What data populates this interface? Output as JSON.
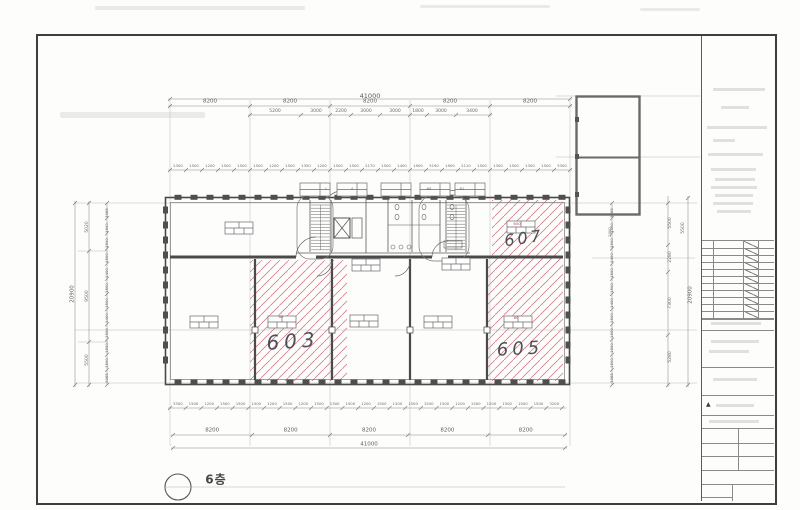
{
  "floor_plan": {
    "floor_label": "6층",
    "room_labels": {
      "left": "603",
      "right": "605",
      "upper": "607"
    },
    "window_tags": [
      "1",
      "4",
      "65",
      "61"
    ],
    "desk_tags": [
      "60",
      "60",
      "600"
    ]
  },
  "dimensions": {
    "top_total": "41000",
    "top_row2": [
      "8200",
      "8200",
      "8200",
      "8200",
      "8200"
    ],
    "top_row3": [
      "5200",
      "3000",
      "2200",
      "3000",
      "3000",
      "1800",
      "3000",
      "3400"
    ],
    "top_small": [
      "2300",
      "1500",
      "1200",
      "1500",
      "1500",
      "1500",
      "1200",
      "1500",
      "1350",
      "1200",
      "1500",
      "1500",
      "2170",
      "1500",
      "1400",
      "1900",
      "3190",
      "1900",
      "2110",
      "1500",
      "1300",
      "1500",
      "1300",
      "1500",
      "3300"
    ],
    "bottom_small": [
      "3300",
      "1500",
      "1200",
      "1500",
      "1500",
      "1500",
      "1200",
      "1500",
      "1200",
      "1500",
      "1300",
      "1500",
      "1200",
      "1500",
      "1200",
      "1500",
      "1500",
      "1500",
      "1200",
      "1500",
      "1200",
      "1500",
      "1500",
      "1500",
      "3200"
    ],
    "bottom_row2": [
      "8200",
      "8200",
      "8200",
      "8200",
      "8200"
    ],
    "bottom_total": "41000",
    "left_total": "20900",
    "left_segments": [
      "5020",
      "9500",
      "5500"
    ],
    "left_small": [
      "3085",
      "1500",
      "1500",
      "1500",
      "1400",
      "1500",
      "1500",
      "1400",
      "1500",
      "1500",
      "1500",
      "3085"
    ],
    "right_total": "20900",
    "right_segments": [
      "5500",
      "2280",
      "7300",
      "5280"
    ],
    "right_small": [
      "3085",
      "1500",
      "1500",
      "1400",
      "1500",
      "1500",
      "1400",
      "1500",
      "1500",
      "1500",
      "1500",
      "3085"
    ],
    "structure_dims": [
      "5500",
      "2000"
    ]
  },
  "colors": {
    "hatch_red": "#cb5e72",
    "pencil": "#3a3a44",
    "line_gray": "#555555"
  }
}
